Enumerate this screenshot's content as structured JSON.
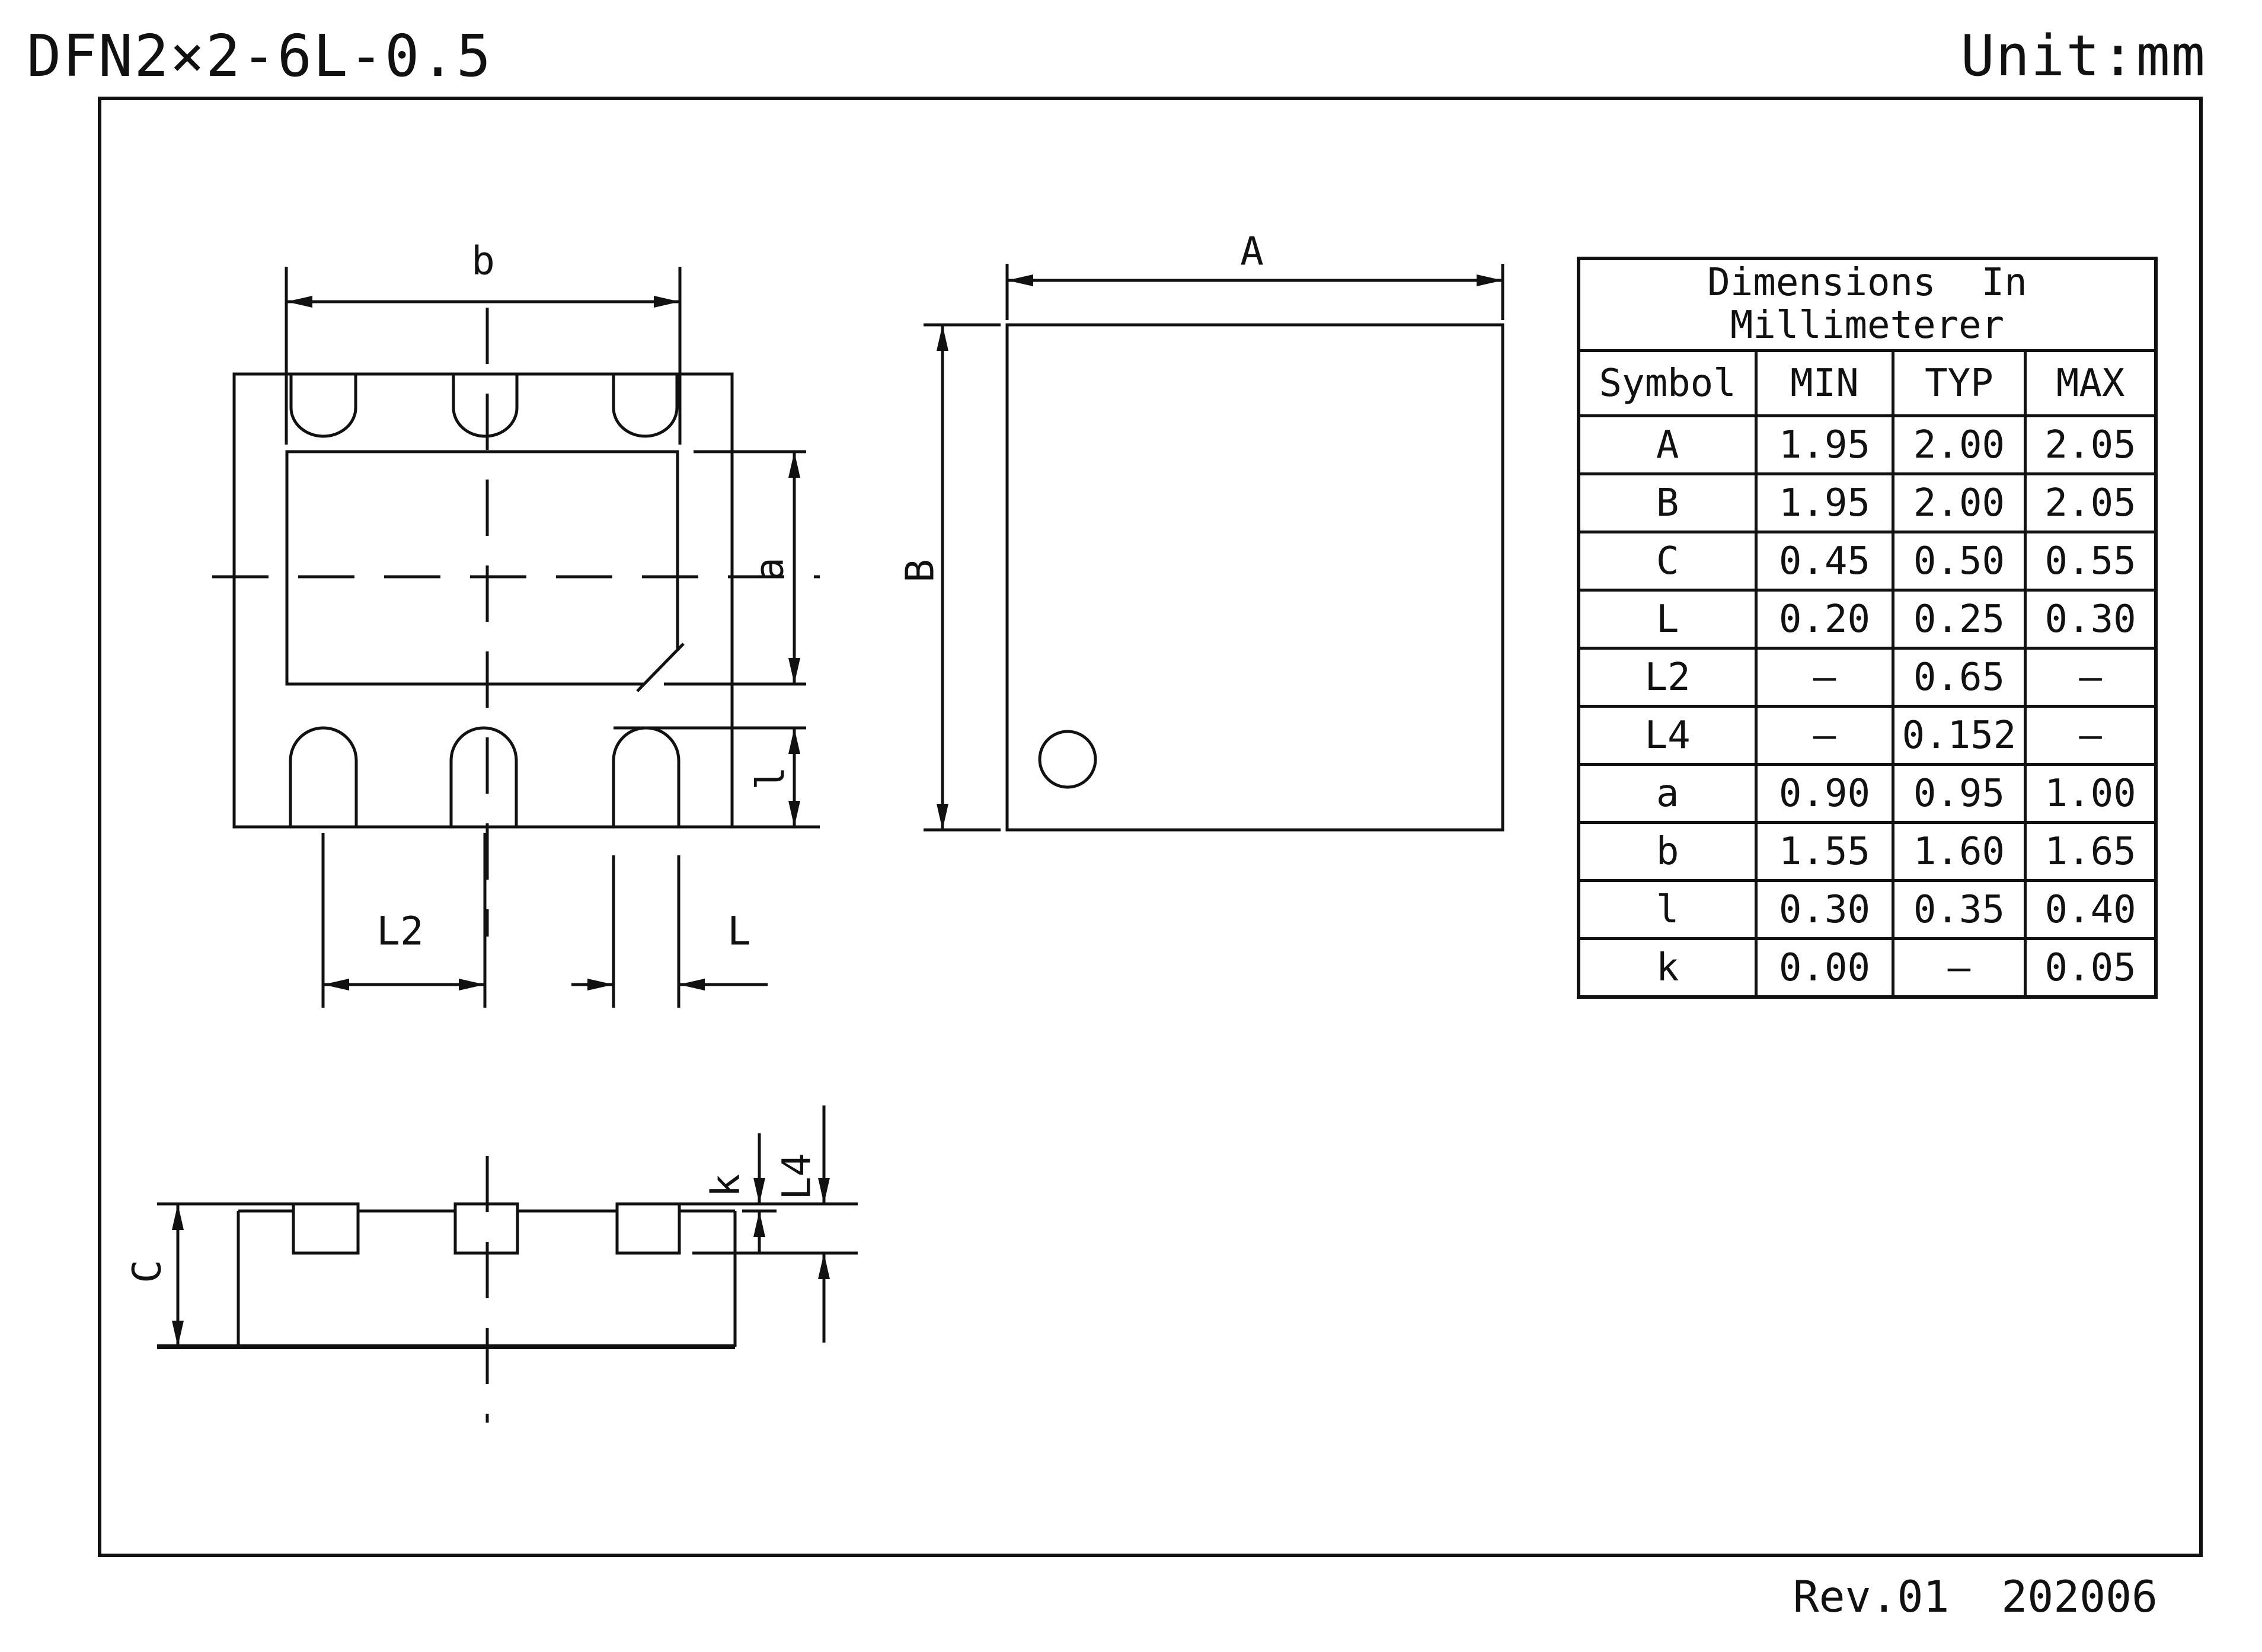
{
  "title": "DFN2×2-6L-0.5",
  "unit_note": "Unit:mm",
  "revision": "Rev.01  202006",
  "table": {
    "title_line1": "Dimensions  In",
    "title_line2": "Millimeterer",
    "columns": [
      "Symbol",
      "MIN",
      "TYP",
      "MAX"
    ],
    "rows": [
      [
        "A",
        "1.95",
        "2.00",
        "2.05"
      ],
      [
        "B",
        "1.95",
        "2.00",
        "2.05"
      ],
      [
        "C",
        "0.45",
        "0.50",
        "0.55"
      ],
      [
        "L",
        "0.20",
        "0.25",
        "0.30"
      ],
      [
        "L2",
        "–",
        "0.65",
        "–"
      ],
      [
        "L4",
        "–",
        "0.152",
        "–"
      ],
      [
        "a",
        "0.90",
        "0.95",
        "1.00"
      ],
      [
        "b",
        "1.55",
        "1.60",
        "1.65"
      ],
      [
        "l",
        "0.30",
        "0.35",
        "0.40"
      ],
      [
        "k",
        "0.00",
        "–",
        "0.05"
      ]
    ]
  },
  "dim_labels": {
    "b": "b",
    "a": "a",
    "L2": "L2",
    "L": "L",
    "l": "l",
    "A": "A",
    "B": "B",
    "C": "C",
    "k": "k",
    "L4": "L4"
  },
  "colors": {
    "ink": "#111111",
    "background": "#ffffff"
  }
}
